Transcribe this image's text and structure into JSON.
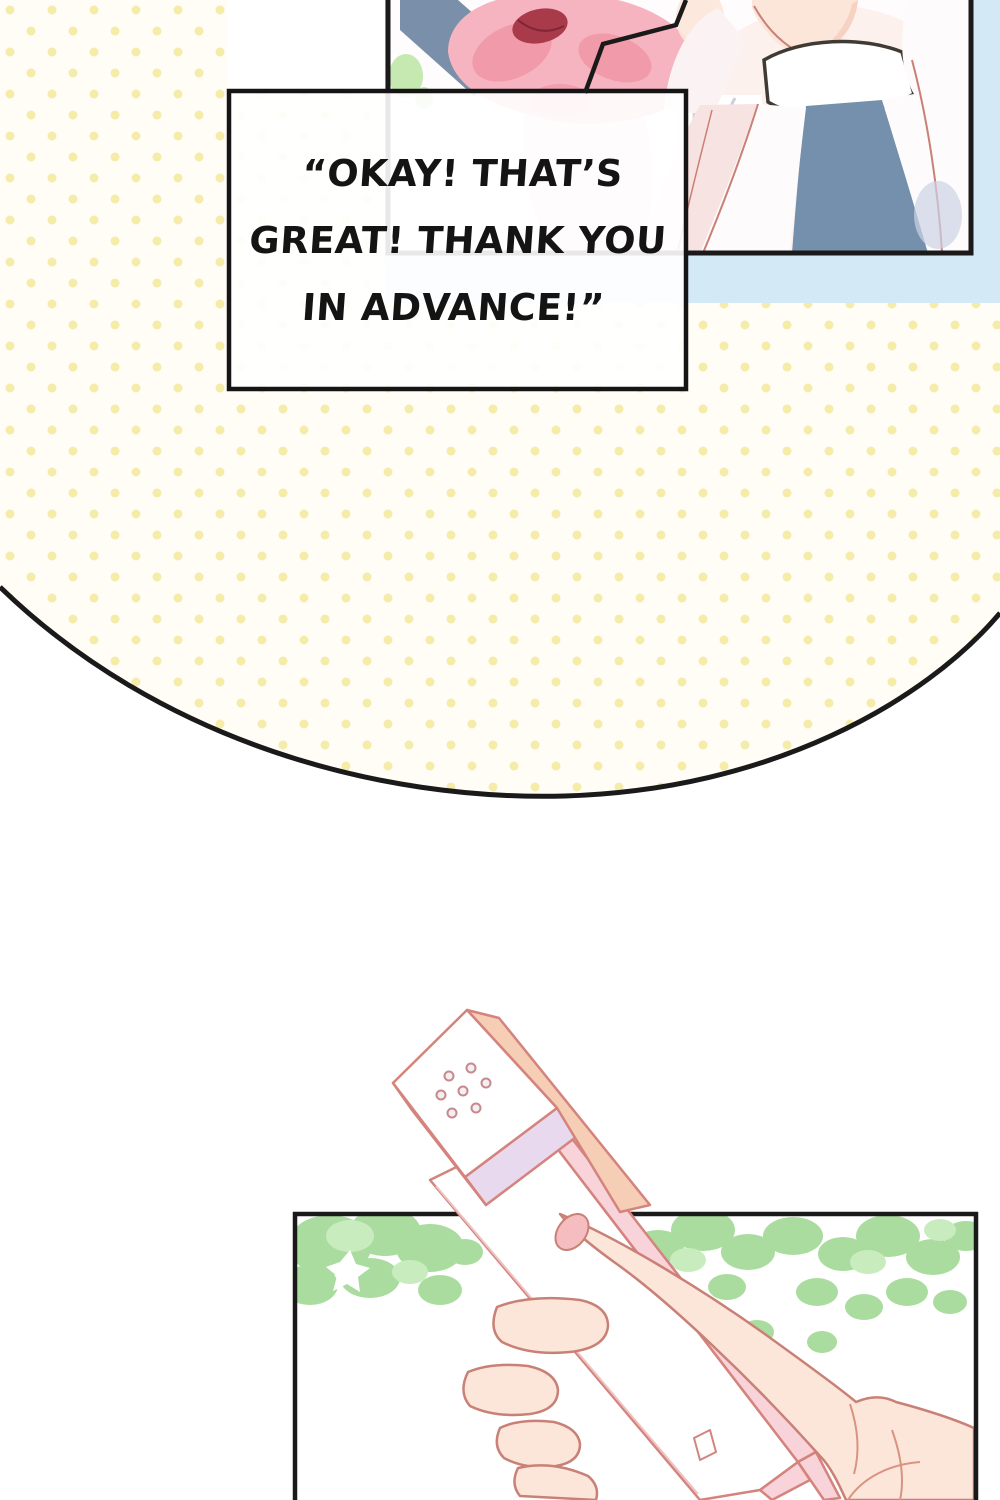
{
  "page": {
    "kind": "comic-page",
    "width": 1000,
    "height": 1500
  },
  "speech_bubble": {
    "lines": [
      "“OKAY! THAT’S",
      "GREAT! THANK YOU",
      "IN ADVANCE!”"
    ],
    "full_text": "“OKAY! THAT’S GREAT! THANK YOU IN ADVANCE!”"
  },
  "colors": {
    "page_bg": "#ffffff",
    "dot_bg": "#fffdf6",
    "dot": "#f6ecaa",
    "sky": "#d3eaf6",
    "line": "#1a1a1a",
    "art_outline": "#c98076",
    "skin": "#fce6d9",
    "skin_shadow": "#f5cdbb",
    "hair_pink": "#f6b4c0",
    "hair_pink_dark": "#ee95a6",
    "hair_pale": "#fbd9df",
    "ribbon_red": "#a83a4a",
    "sash_blue": "#7a90aa",
    "tie_blue": "#7590ac",
    "collar_line": "#403a35",
    "ruffle_line": "#ccd1d9",
    "foliage": "#abdc9f",
    "foliage_light": "#c9ecbf",
    "phone_outline": "#d4837d",
    "phone_white": "#ffffff",
    "phone_peach": "#f6cdb5",
    "phone_pink": "#f8d3da",
    "phone_lavender": "#e9d9ef",
    "nail": "#f5bdc0",
    "bubble_fill": "#ffffff",
    "text": "#141414",
    "shadow_lavender": "#ccd3e6"
  }
}
